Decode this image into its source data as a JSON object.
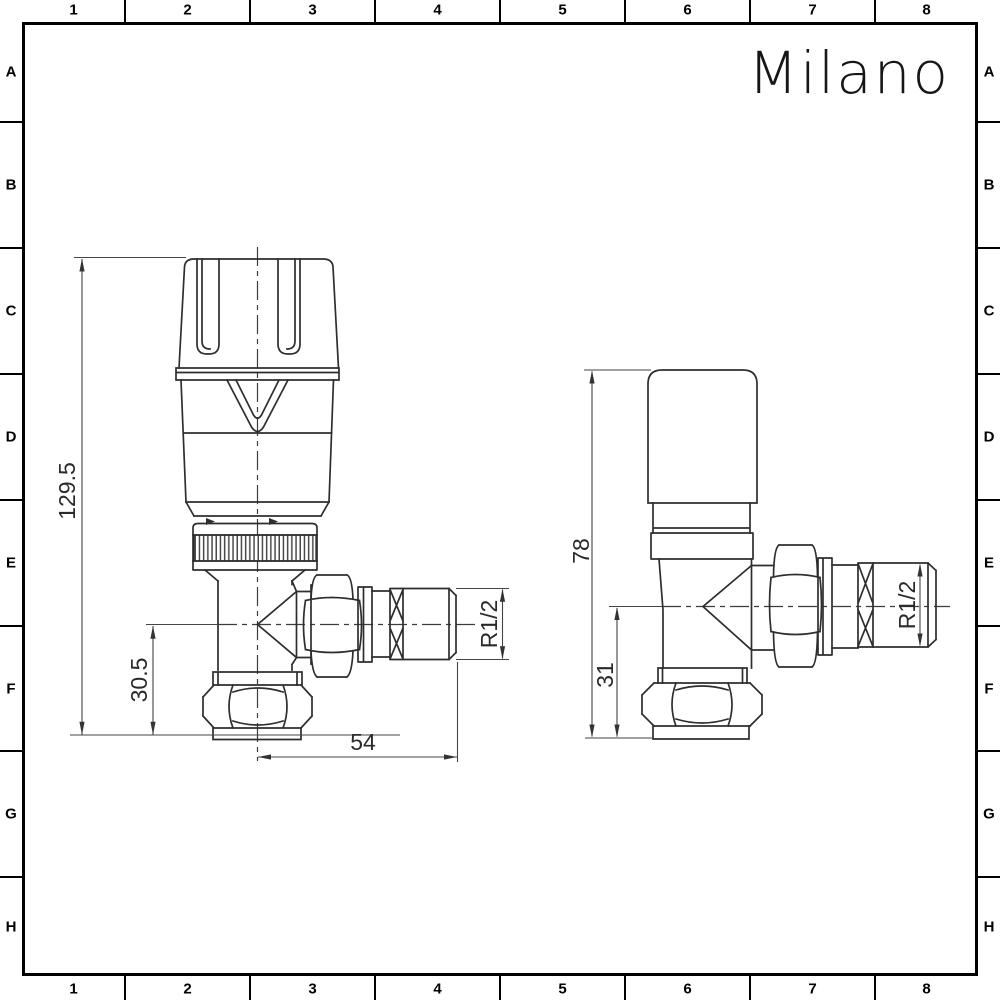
{
  "brand": {
    "logo_text": "Milano"
  },
  "grid": {
    "columns": [
      "1",
      "2",
      "3",
      "4",
      "5",
      "6",
      "7",
      "8"
    ],
    "rows": [
      "A",
      "B",
      "C",
      "D",
      "E",
      "F",
      "G",
      "H"
    ]
  },
  "drawings": {
    "left_valve": {
      "dimensions": {
        "overall_height": "129.5",
        "outlet_center_height": "30.5",
        "center_to_outlet_end": "54",
        "outlet_thread": "R1/2"
      }
    },
    "right_valve": {
      "dimensions": {
        "overall_height": "78",
        "outlet_center_height": "31",
        "outlet_thread": "R1/2"
      }
    }
  },
  "colors": {
    "background": "#ffffff",
    "frame": "#000000",
    "outline": "#2e2e2e",
    "dimension": "#454545",
    "text": "#2a2a2a"
  }
}
